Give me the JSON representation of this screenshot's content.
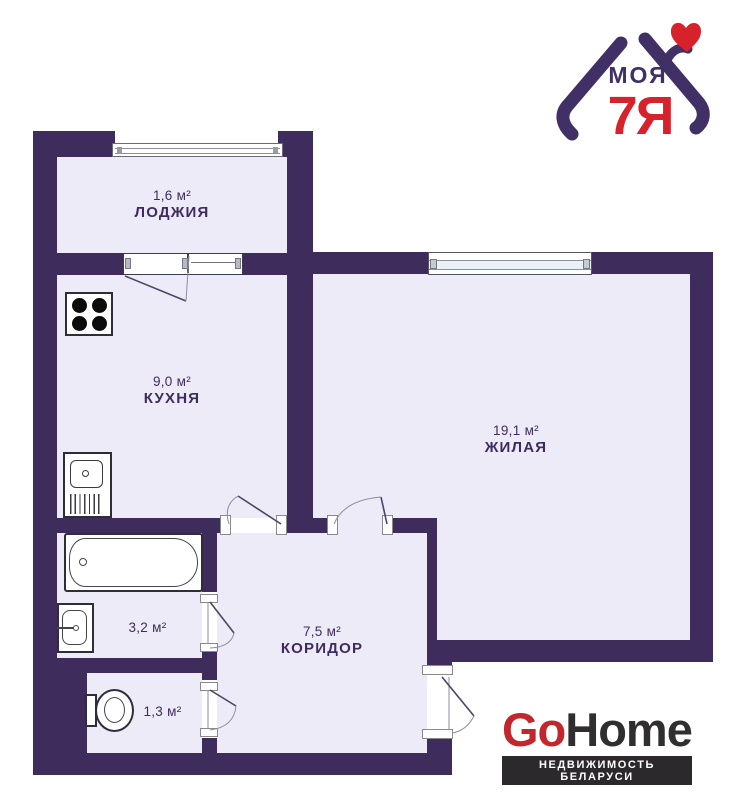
{
  "theme": {
    "page_bg": "#ffffff",
    "wall": "#3e2c5c",
    "room_fill": "#edebf7",
    "ink": "#3f2c5e",
    "leaf_line": "#4a4468",
    "arc_line": "#8d8da5",
    "fixture_line": "#2e2e38",
    "window_blue": "#e9f3f7",
    "jamb_border": "#8a8a8a",
    "logo_purple": "#413066",
    "logo_red": "#d7222b",
    "gohome_red": "#c2272d",
    "gohome_dark": "#2b292c",
    "gohome_ink": "#312e2f"
  },
  "plan": {
    "type": "apartment-floor-plan",
    "rooms": [
      {
        "id": "loggia",
        "name": "ЛОДЖИЯ",
        "area": "1,6 м²"
      },
      {
        "id": "kitchen",
        "name": "КУХНЯ",
        "area": "9,0 м²"
      },
      {
        "id": "living",
        "name": "ЖИЛАЯ",
        "area": "19,1 м²"
      },
      {
        "id": "bathroom",
        "name": "",
        "area": "3,2 м²"
      },
      {
        "id": "wc",
        "name": "",
        "area": "1,3 м²"
      },
      {
        "id": "corridor",
        "name": "КОРИДОР",
        "area": "7,5 м²"
      }
    ],
    "fixtures": [
      "stove-icon",
      "kitchen-sink-icon",
      "bathtub-icon",
      "washbasin-icon",
      "toilet-icon"
    ]
  },
  "logos": {
    "moya7ya": {
      "word": "МОЯ",
      "family": "7Я",
      "icon": "house-with-heart-icon"
    },
    "gohome": {
      "go": "Go",
      "home": "Home",
      "tagline": "НЕДВИЖИМОСТЬ БЕЛАРУСИ"
    }
  }
}
